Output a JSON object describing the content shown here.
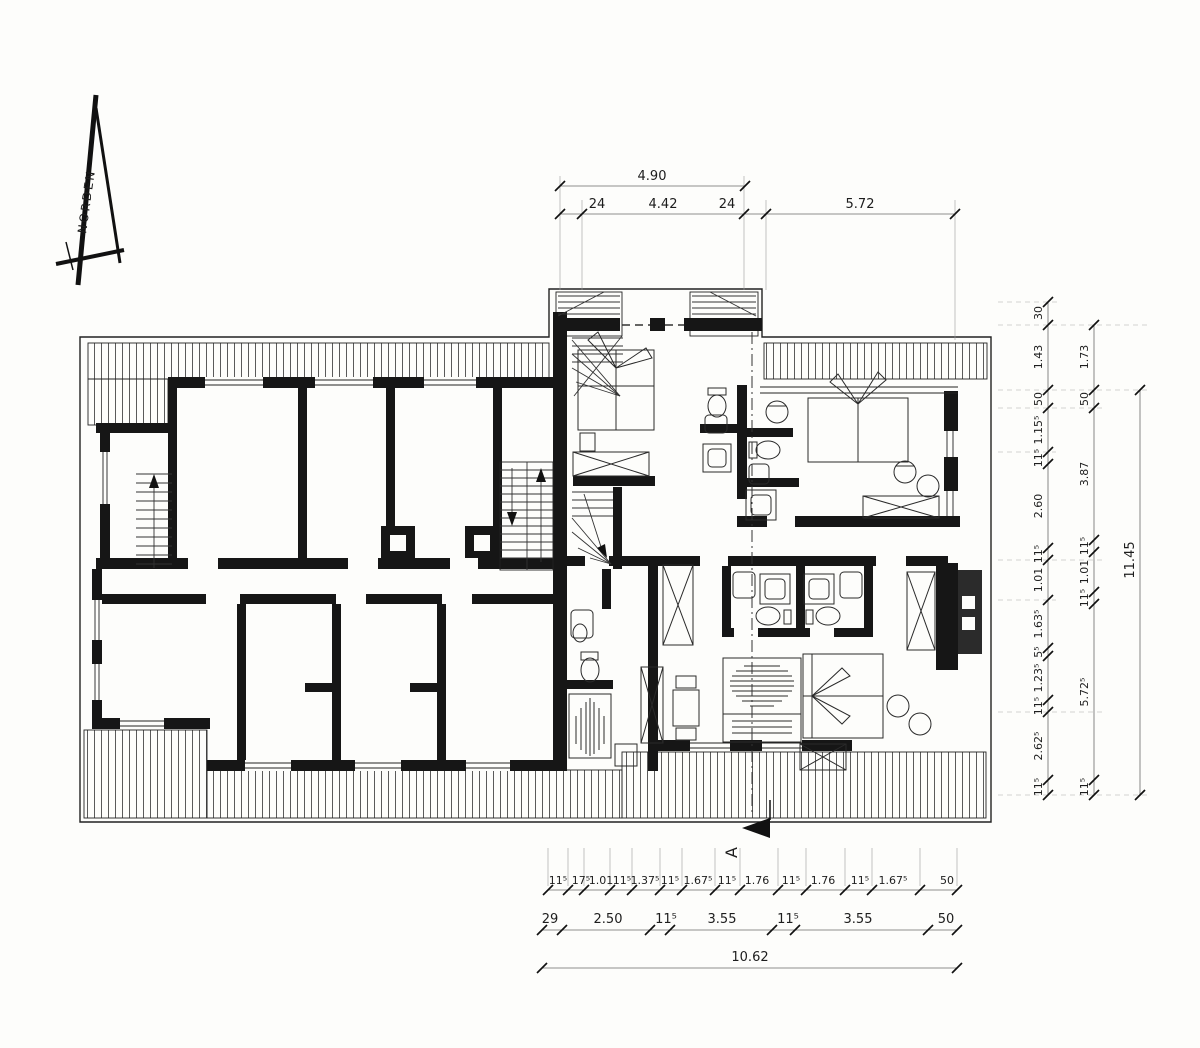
{
  "north": {
    "label": "NORDEN"
  },
  "section_marker": {
    "label": "A"
  },
  "dims": {
    "top": {
      "total": "4.90",
      "row2": [
        "24",
        "4.42",
        "24",
        "5.72"
      ]
    },
    "bottom": {
      "row1": [
        "11⁵",
        "17⁵",
        "1.01",
        "11⁵",
        "1.37⁵",
        "11⁵",
        "1.67⁵",
        "11⁵",
        "1.76",
        "11⁵",
        "1.76",
        "11⁵",
        "1.67⁵",
        "50"
      ],
      "row2": [
        "29",
        "2.50",
        "11⁵",
        "3.55",
        "11⁵",
        "3.55",
        "50"
      ],
      "total": "10.62"
    },
    "right": {
      "inner": [
        "30",
        "1.43",
        "50",
        "1.15⁵",
        "11⁵",
        "2.60",
        "11⁵",
        "1.01",
        "1.63⁵",
        "5⁵",
        "1.23⁵",
        "11⁵",
        "2.62⁵",
        "11⁵"
      ],
      "middle": [
        "1.73",
        "50",
        "3.87",
        "11⁵",
        "1.01",
        "11⁵",
        "5.72⁵",
        "11⁵"
      ],
      "total": "11.45"
    }
  }
}
